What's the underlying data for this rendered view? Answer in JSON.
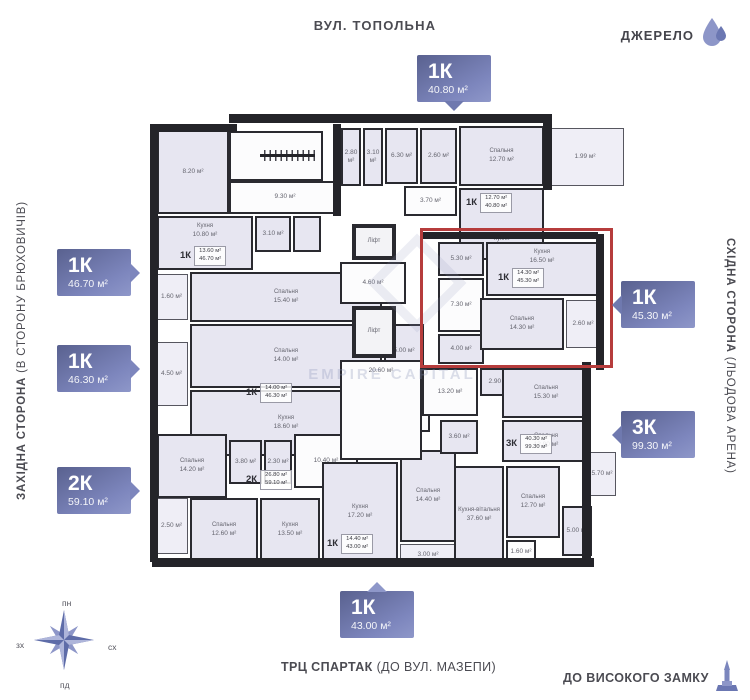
{
  "landmarks": {
    "top_street": "ВУЛ. ТОПОЛЬНА",
    "left_side_bold": "ЗАХІДНА СТОРОНА",
    "left_side_rest": "  (В СТОРОНУ БРЮХОВИЧІВ)",
    "right_side_bold": "СХІДНА СТОРОНА",
    "right_side_rest": " (ЛЬОДОВА АРЕНА)",
    "bottom_left_bold": "ТРЦ СПАРТАК",
    "bottom_left_rest": " (ДО ВУЛ. МАЗЕПИ)",
    "bottom_right": "ДО ВИСОКОГО ЗАМКУ"
  },
  "brand": {
    "name": "ДЖЕРЕЛО"
  },
  "compass": {
    "north": "пн",
    "south": "пд",
    "west": "зх",
    "east": "сх"
  },
  "watermark": "EMPIRE CAPITAL",
  "highlight_color": "#b63c3c",
  "accent_color": "#7d86bd",
  "badges": [
    {
      "rooms": "1К",
      "area": "40.80 м²"
    },
    {
      "rooms": "1К",
      "area": "46.70 м²"
    },
    {
      "rooms": "1К",
      "area": "46.30 м²"
    },
    {
      "rooms": "2К",
      "area": "59.10 м²"
    },
    {
      "rooms": "1К",
      "area": "45.30 м²",
      "highlighted": true
    },
    {
      "rooms": "3К",
      "area": "99.30 м²"
    },
    {
      "rooms": "1К",
      "area": "43.00 м²"
    }
  ],
  "plan": {
    "rooms": [
      {
        "area": "8.20 м²",
        "x": 157,
        "y": 130,
        "w": 72,
        "h": 84,
        "fill": "lav"
      },
      {
        "area": "17.00 м²",
        "x": 229,
        "y": 131,
        "w": 94,
        "h": 50,
        "fill": "white",
        "stairs": true
      },
      {
        "area": "9.30 м²",
        "x": 229,
        "y": 181,
        "w": 112,
        "h": 33,
        "fill": "white"
      },
      {
        "area": "2.80 м²",
        "x": 341,
        "y": 128,
        "w": 20,
        "h": 58,
        "fill": "lav"
      },
      {
        "area": "3.10 м²",
        "x": 363,
        "y": 128,
        "w": 20,
        "h": 58,
        "fill": "lav"
      },
      {
        "area": "6.30 м²",
        "x": 385,
        "y": 128,
        "w": 33,
        "h": 56,
        "fill": "lav"
      },
      {
        "area": "2.60 м²",
        "x": 420,
        "y": 128,
        "w": 37,
        "h": 56,
        "fill": "lav"
      },
      {
        "label": "Спальня",
        "area": "12.70 м²",
        "x": 459,
        "y": 126,
        "w": 85,
        "h": 60,
        "fill": "lav"
      },
      {
        "area": "1.99 м²",
        "x": 546,
        "y": 128,
        "w": 78,
        "h": 58,
        "fill": "lav",
        "thin": true
      },
      {
        "area": "3.70 м²",
        "x": 404,
        "y": 186,
        "w": 53,
        "h": 30,
        "fill": "white"
      },
      {
        "label": "Кухня",
        "area": "12.80 м²",
        "x": 459,
        "y": 188,
        "w": 85,
        "h": 72,
        "fill": "lav",
        "align": "bottom"
      },
      {
        "label": "Кухня",
        "area": "10.80 м²",
        "x": 157,
        "y": 216,
        "w": 96,
        "h": 54,
        "fill": "lav",
        "align": "top"
      },
      {
        "area": "3.10 м²",
        "x": 255,
        "y": 216,
        "w": 36,
        "h": 36,
        "fill": "lav"
      },
      {
        "x": 293,
        "y": 216,
        "w": 28,
        "h": 36,
        "fill": "lav"
      },
      {
        "label": "Спальня",
        "area": "15.40 м²",
        "x": 190,
        "y": 272,
        "w": 192,
        "h": 50,
        "fill": "lav"
      },
      {
        "area": "1.60 м²",
        "x": 155,
        "y": 274,
        "w": 33,
        "h": 46,
        "fill": "lav",
        "thin": true
      },
      {
        "label": "Спальня",
        "area": "14.00 м²",
        "x": 190,
        "y": 324,
        "w": 192,
        "h": 64,
        "fill": "lav"
      },
      {
        "area": "5.00 м²",
        "x": 384,
        "y": 324,
        "w": 40,
        "h": 54,
        "fill": "lav"
      },
      {
        "area": "4.50 м²",
        "x": 155,
        "y": 342,
        "w": 33,
        "h": 64,
        "fill": "lav",
        "thin": true
      },
      {
        "label": "Кухня",
        "area": "18.60 м²",
        "x": 190,
        "y": 390,
        "w": 192,
        "h": 66,
        "fill": "lav"
      },
      {
        "area": "4.22 м²",
        "x": 384,
        "y": 390,
        "w": 46,
        "h": 42,
        "fill": "white"
      },
      {
        "label": "Спальня",
        "area": "14.20 м²",
        "x": 157,
        "y": 434,
        "w": 70,
        "h": 64,
        "fill": "lav"
      },
      {
        "area": "3.80 м²",
        "x": 229,
        "y": 440,
        "w": 33,
        "h": 44,
        "fill": "lav"
      },
      {
        "area": "2.30 м²",
        "x": 264,
        "y": 440,
        "w": 28,
        "h": 44,
        "fill": "lav"
      },
      {
        "area": "10.40 м²",
        "x": 294,
        "y": 434,
        "w": 64,
        "h": 54,
        "fill": "white"
      },
      {
        "label": "Спальня",
        "area": "12.60 м²",
        "x": 190,
        "y": 498,
        "w": 68,
        "h": 64,
        "fill": "lav"
      },
      {
        "area": "2.50 м²",
        "x": 155,
        "y": 498,
        "w": 33,
        "h": 56,
        "fill": "lav",
        "thin": true
      },
      {
        "label": "Кухня",
        "area": "13.50 м²",
        "x": 260,
        "y": 498,
        "w": 60,
        "h": 64,
        "fill": "lav"
      },
      {
        "label": "Кухня",
        "area": "17.20 м²",
        "x": 322,
        "y": 462,
        "w": 76,
        "h": 100,
        "fill": "lav"
      },
      {
        "label": "Спальня",
        "area": "14.40 м²",
        "x": 400,
        "y": 450,
        "w": 56,
        "h": 92,
        "fill": "lav"
      },
      {
        "area": "3.00 м²",
        "x": 400,
        "y": 544,
        "w": 56,
        "h": 22,
        "fill": "white",
        "thin": true
      },
      {
        "label": "Ліфт",
        "x": 352,
        "y": 224,
        "w": 44,
        "h": 36,
        "fill": "white",
        "lift": true
      },
      {
        "area": "4.60 м²",
        "x": 340,
        "y": 262,
        "w": 66,
        "h": 42,
        "fill": "white"
      },
      {
        "label": "Ліфт",
        "x": 352,
        "y": 306,
        "w": 44,
        "h": 52,
        "fill": "white",
        "lift": true
      },
      {
        "area": "20.60 м²",
        "x": 340,
        "y": 360,
        "w": 82,
        "h": 100,
        "fill": "white",
        "align": "top"
      },
      {
        "area": "5.30 м²",
        "x": 438,
        "y": 242,
        "w": 46,
        "h": 34,
        "fill": "lav"
      },
      {
        "area": "7.30 м²",
        "x": 438,
        "y": 278,
        "w": 46,
        "h": 54,
        "fill": "white"
      },
      {
        "area": "4.00 м²",
        "x": 438,
        "y": 334,
        "w": 46,
        "h": 30,
        "fill": "lav"
      },
      {
        "label": "Кухня",
        "area": "16.50 м²",
        "x": 486,
        "y": 242,
        "w": 112,
        "h": 54,
        "fill": "lav",
        "align": "top"
      },
      {
        "label": "Спальня",
        "area": "14.30 м²",
        "x": 480,
        "y": 298,
        "w": 84,
        "h": 52,
        "fill": "lav"
      },
      {
        "area": "2.60 м²",
        "x": 566,
        "y": 300,
        "w": 34,
        "h": 48,
        "fill": "lav",
        "thin": true
      },
      {
        "area": "13.20 м²",
        "x": 422,
        "y": 368,
        "w": 56,
        "h": 48,
        "fill": "white"
      },
      {
        "area": "2.90 м²",
        "x": 480,
        "y": 368,
        "w": 38,
        "h": 28,
        "fill": "lav"
      },
      {
        "label": "Спальня",
        "area": "15.30 м²",
        "x": 502,
        "y": 368,
        "w": 88,
        "h": 50,
        "fill": "lav"
      },
      {
        "label": "Спальня",
        "area": "12.90 м²",
        "x": 502,
        "y": 420,
        "w": 88,
        "h": 42,
        "fill": "lav"
      },
      {
        "area": "3.60 м²",
        "x": 440,
        "y": 420,
        "w": 38,
        "h": 34,
        "fill": "lav"
      },
      {
        "label": "Кухня-вітальня",
        "area": "37.60 м²",
        "x": 454,
        "y": 466,
        "w": 50,
        "h": 98,
        "fill": "lav"
      },
      {
        "label": "Спальня",
        "area": "12.70 м²",
        "x": 506,
        "y": 466,
        "w": 54,
        "h": 72,
        "fill": "lav"
      },
      {
        "area": "1.60 м²",
        "x": 506,
        "y": 540,
        "w": 30,
        "h": 24,
        "fill": "white"
      },
      {
        "area": "5.00 м²",
        "x": 562,
        "y": 506,
        "w": 30,
        "h": 50,
        "fill": "lav"
      },
      {
        "area": "5.70 м²",
        "x": 588,
        "y": 452,
        "w": 28,
        "h": 44,
        "fill": "lav",
        "thin": true
      }
    ],
    "tags": [
      {
        "apt": "1К",
        "living": "13.60 м²",
        "total": "46.70 м²",
        "x": 180,
        "y": 246
      },
      {
        "apt": "1К",
        "living": "12.70 м²",
        "total": "40.80 м²",
        "x": 466,
        "y": 193
      },
      {
        "apt": "1К",
        "living": "14.00 м²",
        "total": "46.30 м²",
        "x": 246,
        "y": 383
      },
      {
        "apt": "2К",
        "living": "26.80 м²",
        "total": "59.10 м²",
        "x": 246,
        "y": 470
      },
      {
        "apt": "1К",
        "living": "14.40 м²",
        "total": "43.00 м²",
        "x": 327,
        "y": 534
      },
      {
        "apt": "1К",
        "living": "14.30 м²",
        "total": "45.30 м²",
        "x": 498,
        "y": 268
      },
      {
        "apt": "3К",
        "living": "40.30 м²",
        "total": "99.30 м²",
        "x": 506,
        "y": 434
      }
    ],
    "walls": [
      [
        229,
        114,
        316,
        9
      ],
      [
        150,
        124,
        87,
        8
      ],
      [
        150,
        126,
        8,
        436
      ],
      [
        152,
        558,
        442,
        9
      ],
      [
        543,
        114,
        9,
        76
      ],
      [
        596,
        234,
        8,
        136
      ],
      [
        582,
        362,
        9,
        200
      ],
      [
        420,
        232,
        178,
        7
      ],
      [
        333,
        124,
        8,
        92
      ]
    ]
  }
}
